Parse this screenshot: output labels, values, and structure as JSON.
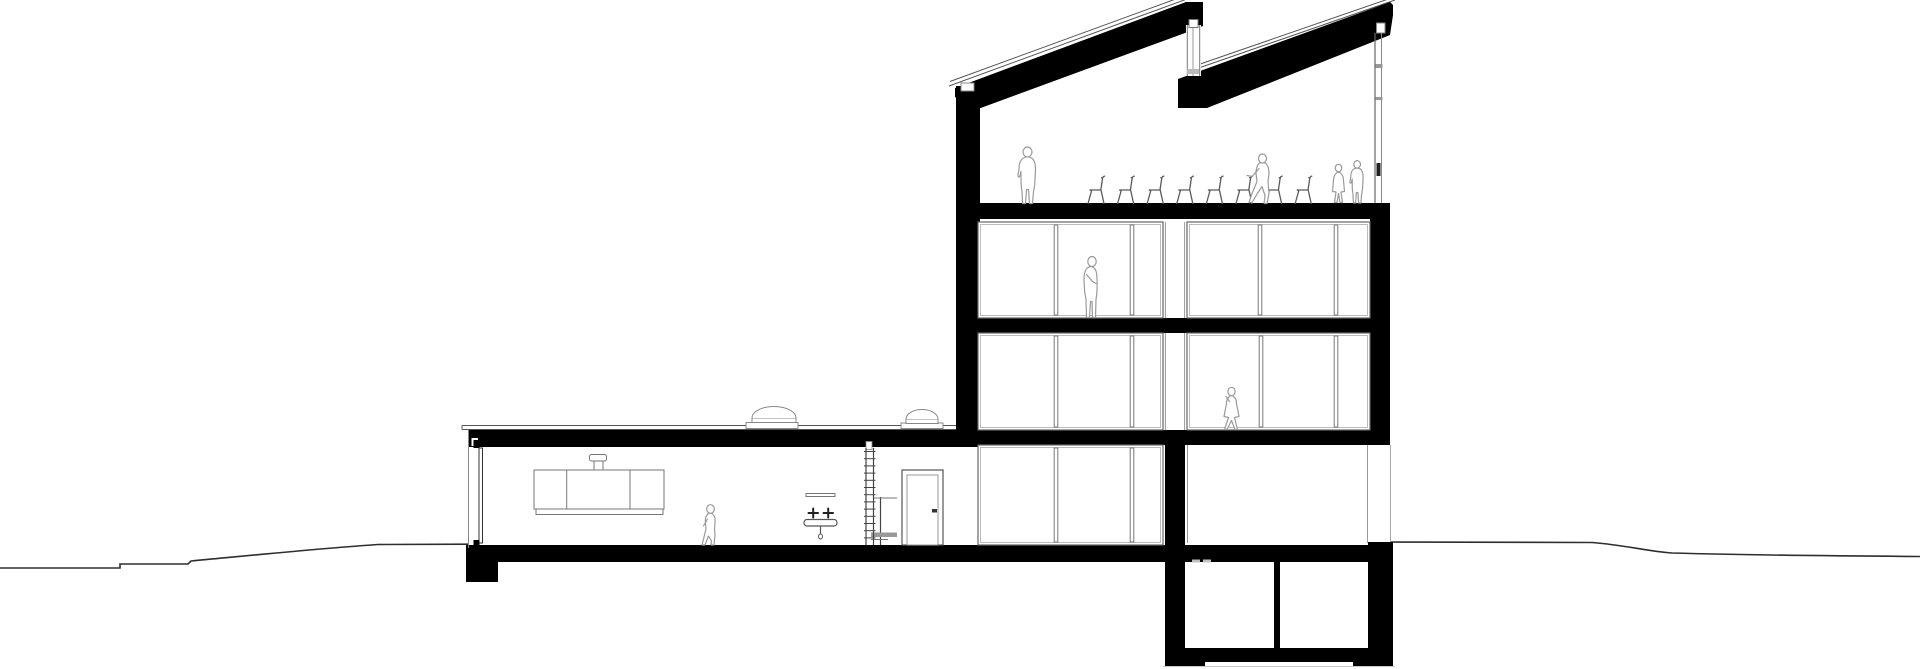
{
  "document": {
    "kind": "architectural-building-section-drawing",
    "visible_text": "none",
    "figure_count": 7,
    "chair_count": 8,
    "skylight_count": 2,
    "basement_room_count": 2
  },
  "canvas": {
    "width": 1920,
    "height": 669,
    "background": "#ffffff"
  },
  "colors": {
    "ink": "#000000",
    "outline_dark": "#555555",
    "outline_mid": "#777777",
    "outline_light": "#bbbbbb",
    "figure": "#9a9a9a",
    "ground": "#2e2e2e"
  },
  "shapes": [
    {
      "name": "ground-line-left",
      "kind": "path",
      "d": "M0,568 L120,568 L120,564 L188,564 L191,561 C255,555 325,548 378,544.5 L468,544.2",
      "stroke": "#2e2e2e",
      "sw": 1.6
    },
    {
      "name": "ground-line-right",
      "kind": "path",
      "d": "M1391,542 L1592,542.5 C1625,545 1645,551 1672,553 C1760,555.5 1850,556 1920,556.5",
      "stroke": "#2e2e2e",
      "sw": 1.6
    },
    {
      "name": "ground-shadow-line",
      "kind": "line",
      "x1": 1163,
      "y1": 666.5,
      "x2": 1395,
      "y2": 666.5,
      "stroke": "#c8c8c8",
      "sw": 1
    },
    {
      "name": "roof1-membrane-a",
      "kind": "line",
      "x1": 949,
      "y1": 86,
      "x2": 1187,
      "y2": -1,
      "stroke": "#555555",
      "sw": 1
    },
    {
      "name": "roof1-membrane-b",
      "kind": "line",
      "x1": 950,
      "y1": 81.5,
      "x2": 1184,
      "y2": -4,
      "stroke": "#555555",
      "sw": 1
    },
    {
      "name": "roof2-membrane-a",
      "kind": "line",
      "x1": 1190,
      "y1": 71,
      "x2": 1395,
      "y2": 0,
      "stroke": "#555555",
      "sw": 1
    },
    {
      "name": "roof2-membrane-b",
      "kind": "line",
      "x1": 1193,
      "y1": 66.5,
      "x2": 1397,
      "y2": -4,
      "stroke": "#555555",
      "sw": 1
    },
    {
      "name": "wing-roofline-a",
      "kind": "line",
      "x1": 462,
      "y1": 425.5,
      "x2": 956,
      "y2": 425.5,
      "stroke": "#555555",
      "sw": 1
    },
    {
      "name": "wing-roofline-b",
      "kind": "line",
      "x1": 462,
      "y1": 429.5,
      "x2": 956,
      "y2": 429.5,
      "stroke": "#555555",
      "sw": 1
    },
    {
      "name": "wing-roofline-end",
      "kind": "line",
      "x1": 462,
      "y1": 425.5,
      "x2": 462,
      "y2": 429.5,
      "stroke": "#555555",
      "sw": 1
    },
    {
      "name": "roof-slope-1",
      "kind": "poly",
      "points": "955,88 1186,2 1203,2 1203,26 1185,33 978,109 955,97",
      "fill": "#000000"
    },
    {
      "name": "roof-slope-2",
      "kind": "poly",
      "points": "1178,79 1390,2 1393,5 1393,15 1390,35 1207,108 1178,108",
      "fill": "#000000"
    },
    {
      "name": "sawtooth-cap",
      "kind": "rect",
      "x": 1185,
      "y": 2,
      "w": 18,
      "h": 24,
      "fill": "#000000"
    },
    {
      "name": "tower-left-wall",
      "kind": "rect",
      "x": 956,
      "y": 86,
      "w": 24,
      "h": 360,
      "fill": "#000000"
    },
    {
      "name": "top-floor-slab",
      "kind": "rect",
      "x": 956,
      "y": 203,
      "w": 434,
      "h": 16,
      "fill": "#000000"
    },
    {
      "name": "level3-slab",
      "kind": "rect",
      "x": 956,
      "y": 318,
      "w": 434,
      "h": 15,
      "fill": "#000000"
    },
    {
      "name": "level2-slab",
      "kind": "rect",
      "x": 956,
      "y": 430,
      "w": 434,
      "h": 15,
      "fill": "#000000"
    },
    {
      "name": "tower-right-wall",
      "kind": "rect",
      "x": 1370,
      "y": 218,
      "w": 20,
      "h": 214,
      "fill": "#000000"
    },
    {
      "name": "wing-roof-slab",
      "kind": "rect",
      "x": 468,
      "y": 430,
      "w": 512,
      "h": 17,
      "fill": "#000000"
    },
    {
      "name": "wing-roof-notch",
      "kind": "rect",
      "x": 471.5,
      "y": 438,
      "w": 6.5,
      "h": 8,
      "fill": "#ffffff"
    },
    {
      "name": "ground-floor-slab",
      "kind": "rect",
      "x": 466,
      "y": 545,
      "w": 924,
      "h": 17,
      "fill": "#000000"
    },
    {
      "name": "left-footing",
      "kind": "rect",
      "x": 466,
      "y": 545,
      "w": 32,
      "h": 37,
      "fill": "#000000"
    },
    {
      "name": "mid-wall",
      "kind": "rect",
      "x": 1165,
      "y": 445,
      "w": 20,
      "h": 117,
      "fill": "#000000"
    },
    {
      "name": "basement-left-wall",
      "kind": "rect",
      "x": 1165,
      "y": 562,
      "w": 20,
      "h": 88,
      "fill": "#000000"
    },
    {
      "name": "basement-divider-wall",
      "kind": "rect",
      "x": 1274,
      "y": 562,
      "w": 6,
      "h": 88,
      "fill": "#000000"
    },
    {
      "name": "basement-right-wall",
      "kind": "rect",
      "x": 1368,
      "y": 542,
      "w": 25,
      "h": 108,
      "fill": "#000000"
    },
    {
      "name": "basement-floor-slab",
      "kind": "rect",
      "x": 1165,
      "y": 648,
      "w": 228,
      "h": 14,
      "fill": "#000000"
    },
    {
      "name": "basement-footing-left",
      "kind": "rect",
      "x": 1165,
      "y": 648,
      "w": 40,
      "h": 18,
      "fill": "#000000"
    },
    {
      "name": "basement-footing-right",
      "kind": "rect",
      "x": 1353,
      "y": 648,
      "w": 40,
      "h": 18,
      "fill": "#000000"
    },
    {
      "name": "roof-vent",
      "kind": "rect",
      "x": 961,
      "y": 83,
      "w": 13,
      "h": 8,
      "fill": "#ffffff",
      "stroke": "#888888",
      "sw": 1
    },
    {
      "name": "wall-strip-l3",
      "kind": "rect",
      "x": 1165,
      "y": 222,
      "w": 20,
      "h": 96,
      "fill": "#ffffff"
    },
    {
      "name": "wall-strip-l3-edge-a",
      "kind": "line",
      "x1": 1165.4,
      "y1": 222,
      "x2": 1165.4,
      "y2": 318,
      "stroke": "#999999",
      "sw": 1
    },
    {
      "name": "wall-strip-l3-edge-b",
      "kind": "line",
      "x1": 1184.6,
      "y1": 222,
      "x2": 1184.6,
      "y2": 318,
      "stroke": "#999999",
      "sw": 1
    },
    {
      "name": "wall-strip-l2",
      "kind": "rect",
      "x": 1165,
      "y": 333,
      "w": 20,
      "h": 97,
      "fill": "#ffffff"
    },
    {
      "name": "wall-strip-l2-edge-a",
      "kind": "line",
      "x1": 1165.4,
      "y1": 333,
      "x2": 1165.4,
      "y2": 430,
      "stroke": "#999999",
      "sw": 1
    },
    {
      "name": "wall-strip-l2-edge-b",
      "kind": "line",
      "x1": 1184.6,
      "y1": 333,
      "x2": 1184.6,
      "y2": 430,
      "stroke": "#999999",
      "sw": 1
    },
    {
      "name": "gf-room-left-face",
      "kind": "line",
      "x1": 1187.5,
      "y1": 445,
      "x2": 1187.5,
      "y2": 543,
      "stroke": "#999999",
      "sw": 1
    },
    {
      "name": "gf-room-right-face",
      "kind": "line",
      "x1": 1367.5,
      "y1": 445,
      "x2": 1367.5,
      "y2": 543,
      "stroke": "#999999",
      "sw": 1
    },
    {
      "name": "gf-wall-exterior-face",
      "kind": "line",
      "x1": 1390.5,
      "y1": 445,
      "x2": 1390.5,
      "y2": 541,
      "stroke": "#aaaaaa",
      "sw": 1
    },
    {
      "name": "gf-floor-dash-a",
      "kind": "rect",
      "x": 1192,
      "y": 559.5,
      "w": 8,
      "h": 3,
      "fill": "#c0c0c0"
    },
    {
      "name": "gf-floor-dash-b",
      "kind": "rect",
      "x": 1203,
      "y": 559.5,
      "w": 8,
      "h": 3,
      "fill": "#c0c0c0"
    },
    {
      "name": "topfloor-glazing-line-a",
      "kind": "line",
      "x1": 1375,
      "y1": 33,
      "x2": 1375,
      "y2": 203,
      "stroke": "#666666",
      "sw": 1.2
    },
    {
      "name": "topfloor-glazing-line-b",
      "kind": "line",
      "x1": 1381.5,
      "y1": 33,
      "x2": 1381.5,
      "y2": 203,
      "stroke": "#888888",
      "sw": 1
    },
    {
      "name": "topfloor-glazing-head",
      "kind": "rect",
      "x": 1376.5,
      "y": 23,
      "w": 8.5,
      "h": 10,
      "fill": "#ffffff",
      "stroke": "#888888",
      "sw": 1
    },
    {
      "name": "topfloor-glazing-transom-a",
      "kind": "rect",
      "x": 1375.5,
      "y": 64,
      "w": 7,
      "h": 4,
      "fill": "#999999"
    },
    {
      "name": "topfloor-glazing-transom-b",
      "kind": "rect",
      "x": 1375.5,
      "y": 97,
      "w": 7,
      "h": 3,
      "fill": "#999999"
    },
    {
      "name": "topfloor-glazing-mark",
      "kind": "rect",
      "x": 1376.5,
      "y": 163,
      "w": 4,
      "h": 13,
      "fill": "#222222"
    },
    {
      "name": "clerestory-glass",
      "kind": "rect",
      "x": 1186,
      "y": 25,
      "w": 15,
      "h": 51,
      "fill": "#ffffff"
    },
    {
      "name": "clerestory-line-a",
      "kind": "line",
      "x1": 1187.3,
      "y1": 25,
      "x2": 1187.3,
      "y2": 76,
      "stroke": "#777777",
      "sw": 1
    },
    {
      "name": "clerestory-line-b",
      "kind": "line",
      "x1": 1193,
      "y1": 25,
      "x2": 1193,
      "y2": 76,
      "stroke": "#999999",
      "sw": 1
    },
    {
      "name": "clerestory-line-c",
      "kind": "line",
      "x1": 1199.7,
      "y1": 25,
      "x2": 1199.7,
      "y2": 76,
      "stroke": "#777777",
      "sw": 1
    },
    {
      "name": "clerestory-frame-box",
      "kind": "rect",
      "x": 1189,
      "y": 19.5,
      "w": 9,
      "h": 8,
      "fill": "#ffffff",
      "stroke": "#777777",
      "sw": 1
    },
    {
      "name": "clerestory-sill",
      "kind": "rect",
      "x": 1187,
      "y": 69,
      "w": 12,
      "h": 5,
      "fill": "#bbbbbb"
    },
    {
      "name": "level2-sill-box",
      "kind": "rect",
      "x": 1041,
      "y": 424.5,
      "w": 12,
      "h": 5,
      "fill": "#aaaaaa",
      "stroke": "#777777",
      "sw": 0.8
    },
    {
      "name": "wing-left-wall-face",
      "kind": "line",
      "x1": 468.5,
      "y1": 430,
      "x2": 468.5,
      "y2": 548,
      "stroke": "#888888",
      "sw": 1
    },
    {
      "name": "wing-left-glazing",
      "kind": "rect",
      "x": 479,
      "y": 448,
      "w": 3.5,
      "h": 95,
      "fill": "#ffffff",
      "stroke": "#333333",
      "sw": 1
    },
    {
      "name": "wing-left-glazing-tick-top",
      "kind": "rect",
      "x": 473.5,
      "y": 440,
      "w": 6,
      "h": 8,
      "fill": "#000000"
    },
    {
      "name": "wing-left-glazing-tick-bottom",
      "kind": "rect",
      "x": 473.5,
      "y": 540,
      "w": 6,
      "h": 8,
      "fill": "#000000"
    },
    {
      "name": "wall-cabinet",
      "kind": "rect",
      "x": 534,
      "y": 470,
      "w": 130,
      "h": 39,
      "fill": "#ffffff",
      "stroke": "#777777",
      "sw": 1
    },
    {
      "name": "wall-cabinet-divider-a",
      "kind": "line",
      "x1": 566.7,
      "y1": 470,
      "x2": 566.7,
      "y2": 509,
      "stroke": "#777777",
      "sw": 1
    },
    {
      "name": "wall-cabinet-divider-b",
      "kind": "line",
      "x1": 630,
      "y1": 470,
      "x2": 630,
      "y2": 509,
      "stroke": "#777777",
      "sw": 1
    },
    {
      "name": "wall-cabinet-base",
      "kind": "rect",
      "x": 536,
      "y": 509,
      "w": 127,
      "h": 5.5,
      "fill": "#ffffff",
      "stroke": "#777777",
      "sw": 1
    },
    {
      "name": "pendant-stem",
      "kind": "rect",
      "x": 594,
      "y": 460,
      "w": 9,
      "h": 10,
      "fill": "#ffffff",
      "stroke": "#777777",
      "sw": 1
    },
    {
      "name": "pendant-cap",
      "kind": "rect",
      "x": 589.5,
      "y": 454.5,
      "w": 17,
      "h": 6.5,
      "rx": 2,
      "fill": "#ffffff",
      "stroke": "#777777",
      "sw": 1
    },
    {
      "name": "basin-mirror",
      "kind": "rect",
      "x": 806,
      "y": 493.5,
      "w": 29,
      "h": 3,
      "fill": "#ffffff",
      "stroke": "#777777",
      "sw": 1
    },
    {
      "name": "basin-tap-left",
      "kind": "path",
      "d": "M808.5,513 L818,513 M813.2,508.5 L813.2,517.5",
      "stroke": "#222222",
      "sw": 2
    },
    {
      "name": "basin-tap-right",
      "kind": "path",
      "d": "M823.5,513 L833,513 M828.2,508.5 L828.2,517.5",
      "stroke": "#222222",
      "sw": 2
    },
    {
      "name": "basin-bowl",
      "kind": "rect",
      "x": 804,
      "y": 519.5,
      "w": 33,
      "h": 6.5,
      "rx": 3,
      "fill": "#ffffff",
      "stroke": "#555555",
      "sw": 1.2
    },
    {
      "name": "basin-drain-pipe",
      "kind": "path",
      "d": "M820.5,526 L820.5,533.5",
      "stroke": "#555555",
      "sw": 1.2
    },
    {
      "name": "basin-drain-trap",
      "kind": "ellipse",
      "cx": 820.5,
      "cy": 536.5,
      "rx": 2,
      "ry": 2.5,
      "fill": "#ffffff",
      "stroke": "#555555",
      "sw": 1
    },
    {
      "name": "ladder-top-fixing",
      "kind": "rect",
      "x": 866,
      "y": 441.5,
      "w": 6,
      "h": 8,
      "fill": "#ffffff",
      "stroke": "#888888",
      "sw": 0.8
    },
    {
      "name": "ladder-pole",
      "kind": "line",
      "x1": 880.5,
      "y1": 497,
      "x2": 880.5,
      "y2": 545,
      "stroke": "#444444",
      "sw": 1.2
    },
    {
      "name": "ladder-bracket",
      "kind": "line",
      "x1": 874,
      "y1": 498,
      "x2": 897,
      "y2": 498,
      "stroke": "#777777",
      "sw": 1
    },
    {
      "name": "ladder-step-bar",
      "kind": "rect",
      "x": 871,
      "y": 532.5,
      "w": 26,
      "h": 4.5,
      "fill": "#999999"
    },
    {
      "name": "ladder-step-line",
      "kind": "line",
      "x1": 871,
      "y1": 539.5,
      "x2": 888,
      "y2": 539.5,
      "stroke": "#777777",
      "sw": 1
    },
    {
      "name": "door-frame",
      "kind": "rect",
      "x": 902,
      "y": 470,
      "w": 41,
      "h": 75,
      "fill": "#ffffff",
      "stroke": "#555555",
      "sw": 1.2
    },
    {
      "name": "door-leaf",
      "kind": "rect",
      "x": 907,
      "y": 475,
      "w": 31,
      "h": 70,
      "fill": "#ffffff",
      "stroke": "#999999",
      "sw": 1
    },
    {
      "name": "door-handle",
      "kind": "rect",
      "x": 932,
      "y": 509,
      "w": 5,
      "h": 3.5,
      "fill": "#333333"
    }
  ],
  "window_bands": [
    {
      "name": "window-band-l3-left",
      "x": 978,
      "y": 222,
      "w": 185,
      "h": 96,
      "mullions": [
        1056,
        1132
      ]
    },
    {
      "name": "window-band-l3-right",
      "x": 1187,
      "y": 222,
      "w": 183,
      "h": 96,
      "mullions": [
        1260,
        1336
      ]
    },
    {
      "name": "window-band-l2-left",
      "x": 978,
      "y": 333,
      "w": 185,
      "h": 97,
      "mullions": [
        1056,
        1132
      ]
    },
    {
      "name": "window-band-l2-right",
      "x": 1187,
      "y": 333,
      "w": 183,
      "h": 97,
      "mullions": [
        1261,
        1336
      ]
    },
    {
      "name": "window-band-gf-left",
      "x": 978,
      "y": 445,
      "w": 185,
      "h": 100,
      "mullions": [
        1056,
        1132
      ]
    }
  ],
  "skylights": [
    {
      "name": "skylight-dome-1",
      "base": {
        "x": 746,
        "y": 422.5,
        "w": 52,
        "h": 6
      },
      "mid": {
        "x": 752,
        "y": 418,
        "w": 44,
        "h": 4.5
      },
      "dome": "M752,418 A22,11.5 0 0 1 796,418"
    },
    {
      "name": "skylight-dome-2",
      "base": {
        "x": 901,
        "y": 423,
        "w": 42,
        "h": 5.5
      },
      "mid": {
        "x": 906,
        "y": 419,
        "w": 32,
        "h": 4.5
      },
      "dome": "M906,419 A16,9.5 0 0 1 938,419"
    }
  ],
  "ladder": {
    "x_rail_a": 866,
    "x_rail_b": 873.5,
    "top": 448,
    "bottom": 545,
    "rung_start": 451.5,
    "rung_step": 7.2,
    "rung_count": 13,
    "stroke": "#444444"
  },
  "chairs": {
    "count": 8,
    "x_start": 1087,
    "spacing": 29.6,
    "baseline": 203.5,
    "stroke": "#5a5a5a",
    "path": "M1,0 L4.5,-12.5 L3,-13.5 L14,-13.5 L17,0 M13.8,-13.5 L15.6,-25.5 C15.9,-26.6 16.6,-27.2 17.6,-27.4 M15.6,-25.5 L14.6,-25.8"
  },
  "figures": [
    {
      "name": "figure-standing-man-topfloor",
      "x": 1028,
      "y": 203.5,
      "scale": 1,
      "head": {
        "cx": -0.5,
        "cy": -51.5,
        "rx": 4.5,
        "ry": 5
      },
      "body": "M-4.5,-45.5 C-7.5,-44 -9,-40 -9,-34 L-10,-29 C-10.5,-26 -8.5,-25.5 -8,-28 L-7,-32 L-7,-22 C-7,-18 -6.5,-15 -6,-12 L-5.5,0 L-2.5,0 L-1.5,-14 L0.5,-14 L1.5,0 L4.5,0 L5.5,-12 C6.5,-16 7,-20 7,-24 L7.5,-34 C7.5,-40 6,-44 3.5,-45.5 C1,-47 -2,-47 -4.5,-45.5 Z",
      "arms": []
    },
    {
      "name": "figure-walking-man-topfloor",
      "x": 1263,
      "y": 203.5,
      "scale": 1,
      "head": {
        "cx": -0.5,
        "cy": -45,
        "rx": 4,
        "ry": 4.5
      },
      "body": "M-4,-40 C-6,-38 -7,-34 -7,-30 L-6,-22 L-11,-10 L-14,-1 L-11,-1 L-5,-11 L-1,-17 L2,-8 L1,0 L4,0 L6,-10 L5,-22 L6,-30 C6,-35 5,-38 3,-40 C1,-41.5 -2,-41.5 -4,-40 Z",
      "arms": [
        "M-4,-35 L-11,-27 L-16,-28"
      ]
    },
    {
      "name": "figure-standing-woman-topfloor",
      "x": 1338.5,
      "y": 202.5,
      "scale": 1,
      "head": {
        "cx": 0,
        "cy": -34.5,
        "rx": 3.2,
        "ry": 3.8
      },
      "body": "M-2.5,-29 C-4,-27.5 -5,-25 -5,-22 L-6,-11 L-2.5,-10.5 L-4,0 L-1.5,0 L0,-9 L1.5,0 L4,0 L2.5,-10.5 L6,-11 L5,-22 C5,-25 4,-27.5 2.5,-29 C1,-30.5 -1,-30.5 -2.5,-29 Z",
      "arms": []
    },
    {
      "name": "figure-standing-man-pair",
      "x": 1357.5,
      "y": 203,
      "scale": 0.75,
      "head": {
        "cx": -0.5,
        "cy": -51.5,
        "rx": 4.5,
        "ry": 5
      },
      "body": "M-4.5,-45.5 C-7.5,-44 -9,-40 -9,-34 L-10,-29 C-10.5,-26 -8.5,-25.5 -8,-28 L-7,-32 L-7,-22 C-7,-18 -6.5,-15 -6,-12 L-5.5,0 L-2.5,0 L-1.5,-14 L0.5,-14 L1.5,0 L4.5,0 L5.5,-12 C6.5,-16 7,-20 7,-24 L7.5,-34 C7.5,-40 6,-44 3.5,-45.5 C1,-47 -2,-47 -4.5,-45.5 Z",
      "arms": []
    },
    {
      "name": "figure-standing-person-level3",
      "x": 1091.5,
      "y": 317.5,
      "scale": 1,
      "head": {
        "cx": 0.5,
        "cy": -56,
        "rx": 4.2,
        "ry": 5
      },
      "body": "M-3.5,-50 C-6,-48.5 -7.5,-44 -7.5,-38 L-7,-28 C-7,-25 -6,-22 -5.5,-18 L-5,0 L-2,0 L-1,-16 L0.5,-16 L1,0 L4,0 L4.5,-18 C5.5,-24 6,-30 5.5,-38 C5.5,-44 4.5,-48.5 2,-50 C0,-51.5 -1.5,-51.5 -3.5,-50 Z",
      "arms": [
        "M-5,-43 L1,-36 L4.5,-34"
      ]
    },
    {
      "name": "figure-walking-woman-level2",
      "x": 1231.5,
      "y": 430.5,
      "scale": 1,
      "head": {
        "cx": 0,
        "cy": -39,
        "rx": 3.6,
        "ry": 4.2
      },
      "body": "M-2,-34 C-4,-32.5 -5,-30 -5,-27 L-7.5,-14 L-3,-13 L-7,-1 L-4.5,-1 L0,-10 L3.5,-1 L6,-1 L3,-13 L7.5,-14 L5,-27 C5,-30 4,-32.5 2,-34 C0.5,-35.5 -0.5,-35.5 -2,-34 Z",
      "arms": [
        "M-2,-29 L-5.5,-34"
      ]
    },
    {
      "name": "figure-child-wing",
      "x": 710.5,
      "y": 545,
      "scale": 1,
      "head": {
        "cx": 0,
        "cy": -36,
        "rx": 3.8,
        "ry": 4.3
      },
      "body": "M-2.5,-31 C-4.5,-29.5 -5.5,-26 -5,-22 L-4.5,-16 L-7,-6 L-8.5,0 L-5.5,0 L-2,-9 L1,-4 L0.5,0 L3.5,0 L4.5,-10 L4,-16 L4.5,-22 C5,-26 4,-29.5 2,-31 C0.5,-32.5 -1,-32.5 -2.5,-31 Z",
      "arms": [
        "M-3,-26 L-7,-19"
      ]
    }
  ]
}
